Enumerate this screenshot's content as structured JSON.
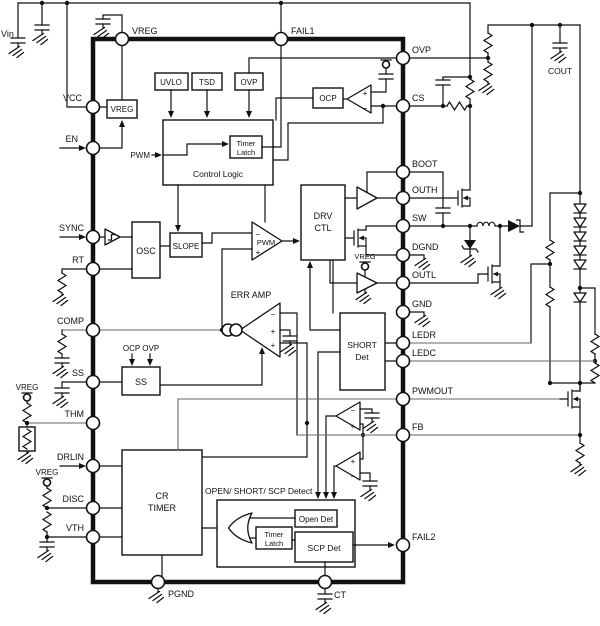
{
  "diagram": {
    "pins": {
      "top": [
        "VREG",
        "FAIL1"
      ],
      "left": [
        "VCC",
        "EN",
        "SYNC",
        "RT",
        "COMP",
        "SS",
        "THM",
        "DRLIN",
        "DISC",
        "VTH"
      ],
      "right": [
        "OVP",
        "CS",
        "BOOT",
        "OUTH",
        "SW",
        "DGND",
        "OUTL",
        "GND",
        "LEDR",
        "LEDC",
        "PWMOUT",
        "FB",
        "FAIL2"
      ],
      "bottom": [
        "PGND",
        "CT"
      ]
    },
    "blocks": {
      "vreg": "VREG",
      "uvlo": "UVLO",
      "tsd": "TSD",
      "ovp": "OVP",
      "timer_latch": [
        "Timer",
        "Latch"
      ],
      "control_logic": "Control Logic",
      "pwm_input": "PWM",
      "ocp": "OCP",
      "osc": "OSC",
      "slope": "SLOPE",
      "pwm_comparator": "PWM",
      "drv_ctl": [
        "DRV",
        "CTL"
      ],
      "err_amp": "ERR AMP",
      "ss": "SS",
      "ss_inputs": "OCP OVP",
      "short_det": [
        "SHORT",
        "Det"
      ],
      "cr_timer": [
        "CR",
        "TIMER"
      ],
      "detect_title": "OPEN/ SHORT/ SCP Detect",
      "open_det": "Open Det",
      "timer_latch2": [
        "Timer",
        "Latch"
      ],
      "scp_det": "SCP Det",
      "drv_vreg": "VREG"
    },
    "external": {
      "vin": "Vin",
      "cout": "COUT",
      "thm_pullup": "VREG",
      "disc_pullup": "VREG"
    },
    "signs": {
      "plus": "+",
      "minus": "−"
    }
  }
}
